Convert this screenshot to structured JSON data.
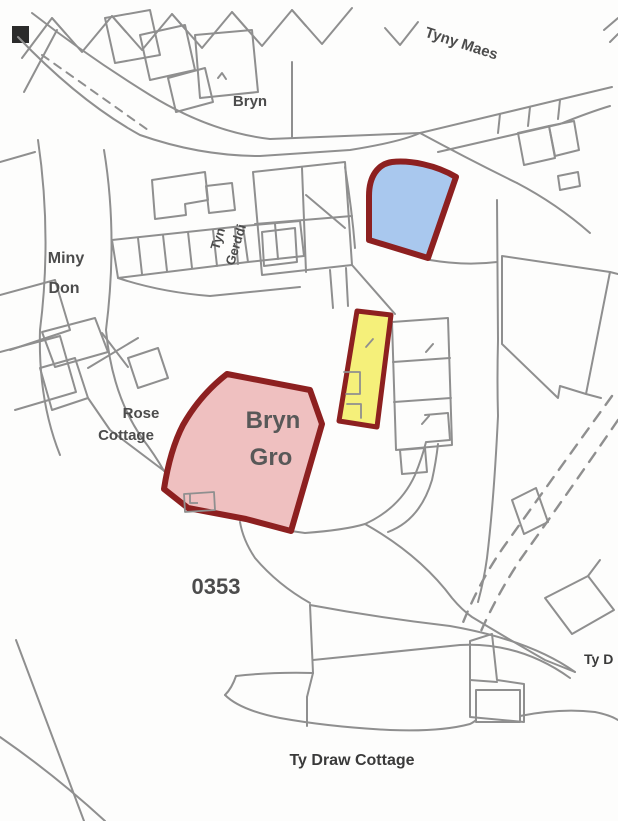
{
  "map": {
    "type": "cadastral-plan",
    "labels": {
      "tyny_maes": "Tyny Maes",
      "bryn_house": "Bryn",
      "tyn_gerddi_line1": "Tyn",
      "tyn_gerddi_line2": "Gerddi",
      "miny_don_line1": "Miny",
      "miny_don_line2": "Don",
      "rose_cottage_line1": "Rose",
      "rose_cottage_line2": "Cottage",
      "plot_number": "0353",
      "ty_draw_cottage": "Ty Draw Cottage",
      "ty_d_partial": "Ty D"
    },
    "parcels": [
      {
        "id": "blue-parcel",
        "fill": "#a9c8ee",
        "outline": "#8d2020"
      },
      {
        "id": "yellow-parcel",
        "fill": "#f5f07a",
        "outline": "#8d2020"
      },
      {
        "id": "bryn-gro-parcel",
        "fill": "#efc0c0",
        "outline": "#8d2020",
        "label_line1": "Bryn",
        "label_line2": "Gro"
      }
    ],
    "colors": {
      "map_line": "#8f8f8f",
      "label_text": "#4c4c4c",
      "dark_label_text": "#3a3a3a",
      "corner_mark": "#2b2b2b",
      "background": "#fdfdfc"
    }
  }
}
